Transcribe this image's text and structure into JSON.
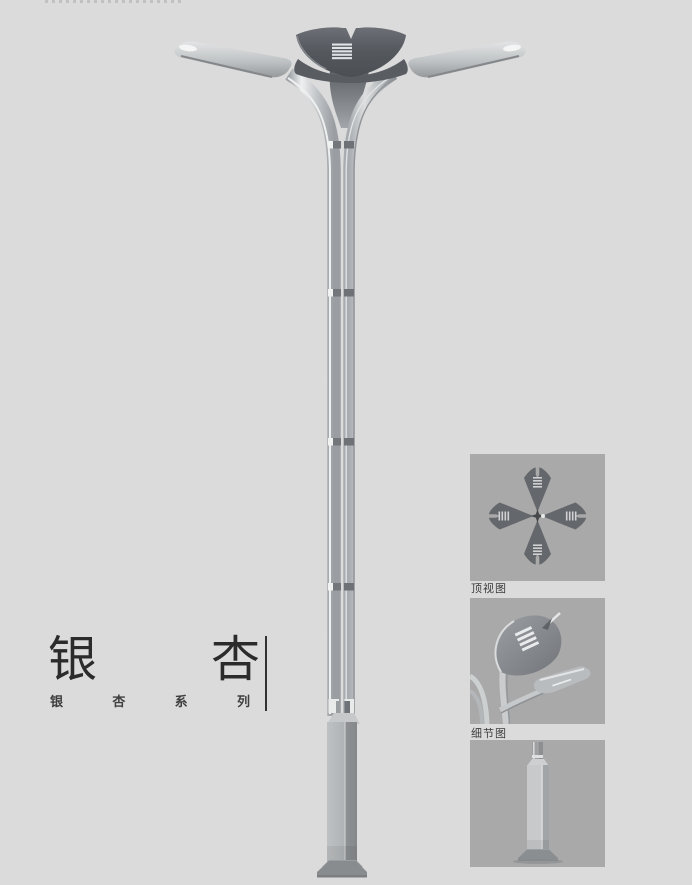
{
  "title_block": {
    "title_char_1": "银",
    "title_char_2": "杏",
    "series_chars": [
      "银",
      "杏",
      "系",
      "列"
    ]
  },
  "detail_panels": [
    {
      "id": "top-view",
      "label": "顶视图"
    },
    {
      "id": "detail-view",
      "label": "细节图"
    },
    {
      "id": "base-view"
    }
  ],
  "colors": {
    "background": "#dbdbdb",
    "panel_background": "#a9a9a9",
    "metal_light": "#c6c9cb",
    "metal_dark": "#5a5e63",
    "title_text": "#2b2b2b",
    "label_text": "#3c3c3c"
  }
}
